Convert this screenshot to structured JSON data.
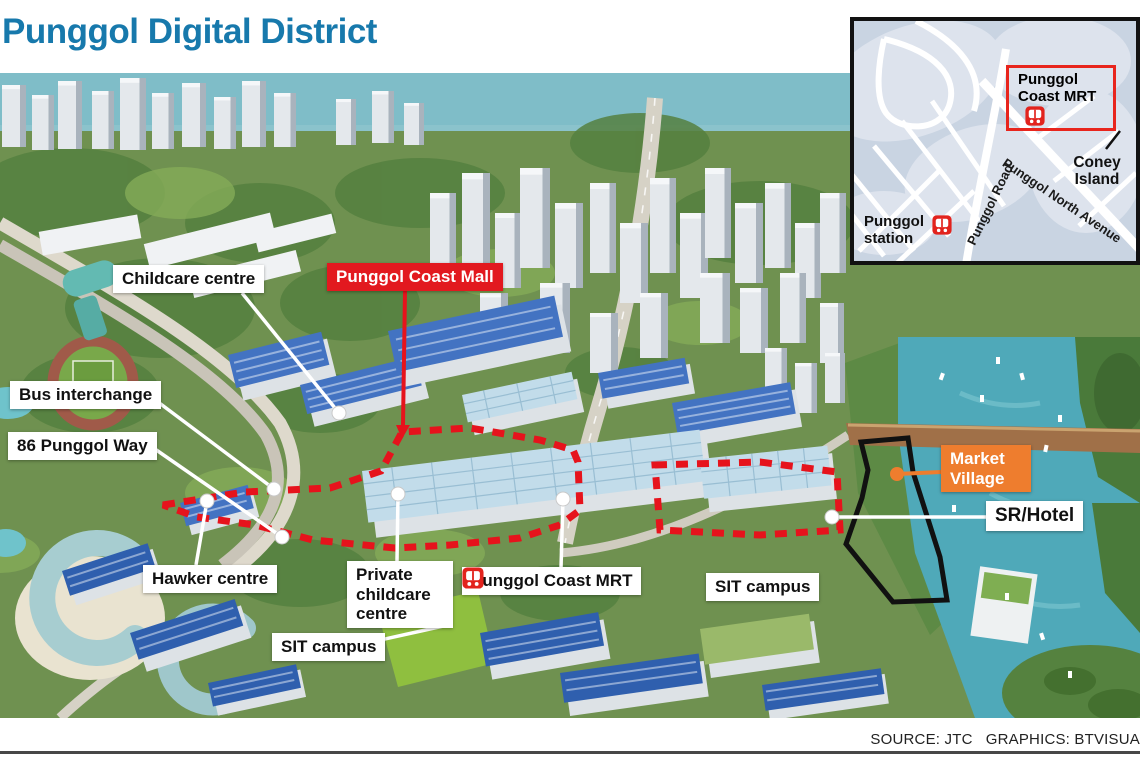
{
  "title": "Punggol Digital District",
  "footer": {
    "source": "SOURCE: JTC   GRAPHICS: BTVISUA"
  },
  "labels": {
    "childcare_centre": "Childcare centre",
    "punggol_coast_mall": "Punggol Coast Mall",
    "bus_interchange": "Bus interchange",
    "punggol_way": "86 Punggol Way",
    "hawker_centre": "Hawker centre",
    "private_childcare_centre": "Private childcare centre",
    "punggol_coast_mrt": "Punggol Coast MRT",
    "sit_campus_west": "SIT campus",
    "sit_campus_east": "SIT campus",
    "market_village": "Market Village",
    "sr_hotel": "SR/Hotel"
  },
  "inset": {
    "punggol_coast_mrt": "Punggol Coast MRT",
    "coney_island": "Coney Island",
    "punggol_station": "Punggol station",
    "punggol_road": "Punggol Road",
    "punggol_north_avenue": "Punggol North Avenue"
  },
  "colors": {
    "title_blue": "#1779ac",
    "highlight_red": "#e2191f",
    "highlight_orange": "#ee7d2e",
    "district_boundary_red": "#e6131c",
    "market_village_boundary_black": "#111111",
    "water_teal": "#4fa9b9"
  }
}
